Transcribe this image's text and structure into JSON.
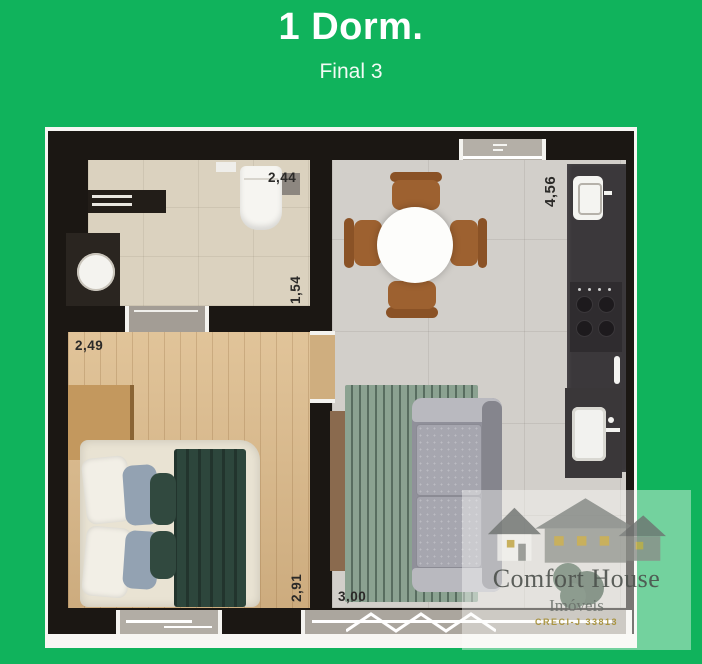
{
  "header": {
    "title": "1 Dorm.",
    "subtitle": "Final 3"
  },
  "floorplan": {
    "measurements": {
      "bathroom_width": "2,44",
      "bathroom_depth": "1,54",
      "bedroom_width": "2,49",
      "kitchen_living_depth": "4,56",
      "bedroom_depth": "2,91",
      "living_width": "3,00"
    }
  },
  "watermark": {
    "brand": "Comfort House",
    "subtitle": "Imóveis",
    "registration": "CRECI-J 33813",
    "logo_icon": "houses-icon"
  },
  "colors": {
    "background_green": "#10b35c",
    "wall_dark": "#1b1713",
    "wood_floor": "#d7b78a",
    "tile_floor": "#d2cfca",
    "bath_floor": "#dbd2bf",
    "blanket_green": "#2d463c",
    "sofa_gray": "#90909a",
    "chair_brown": "#9d6130"
  }
}
